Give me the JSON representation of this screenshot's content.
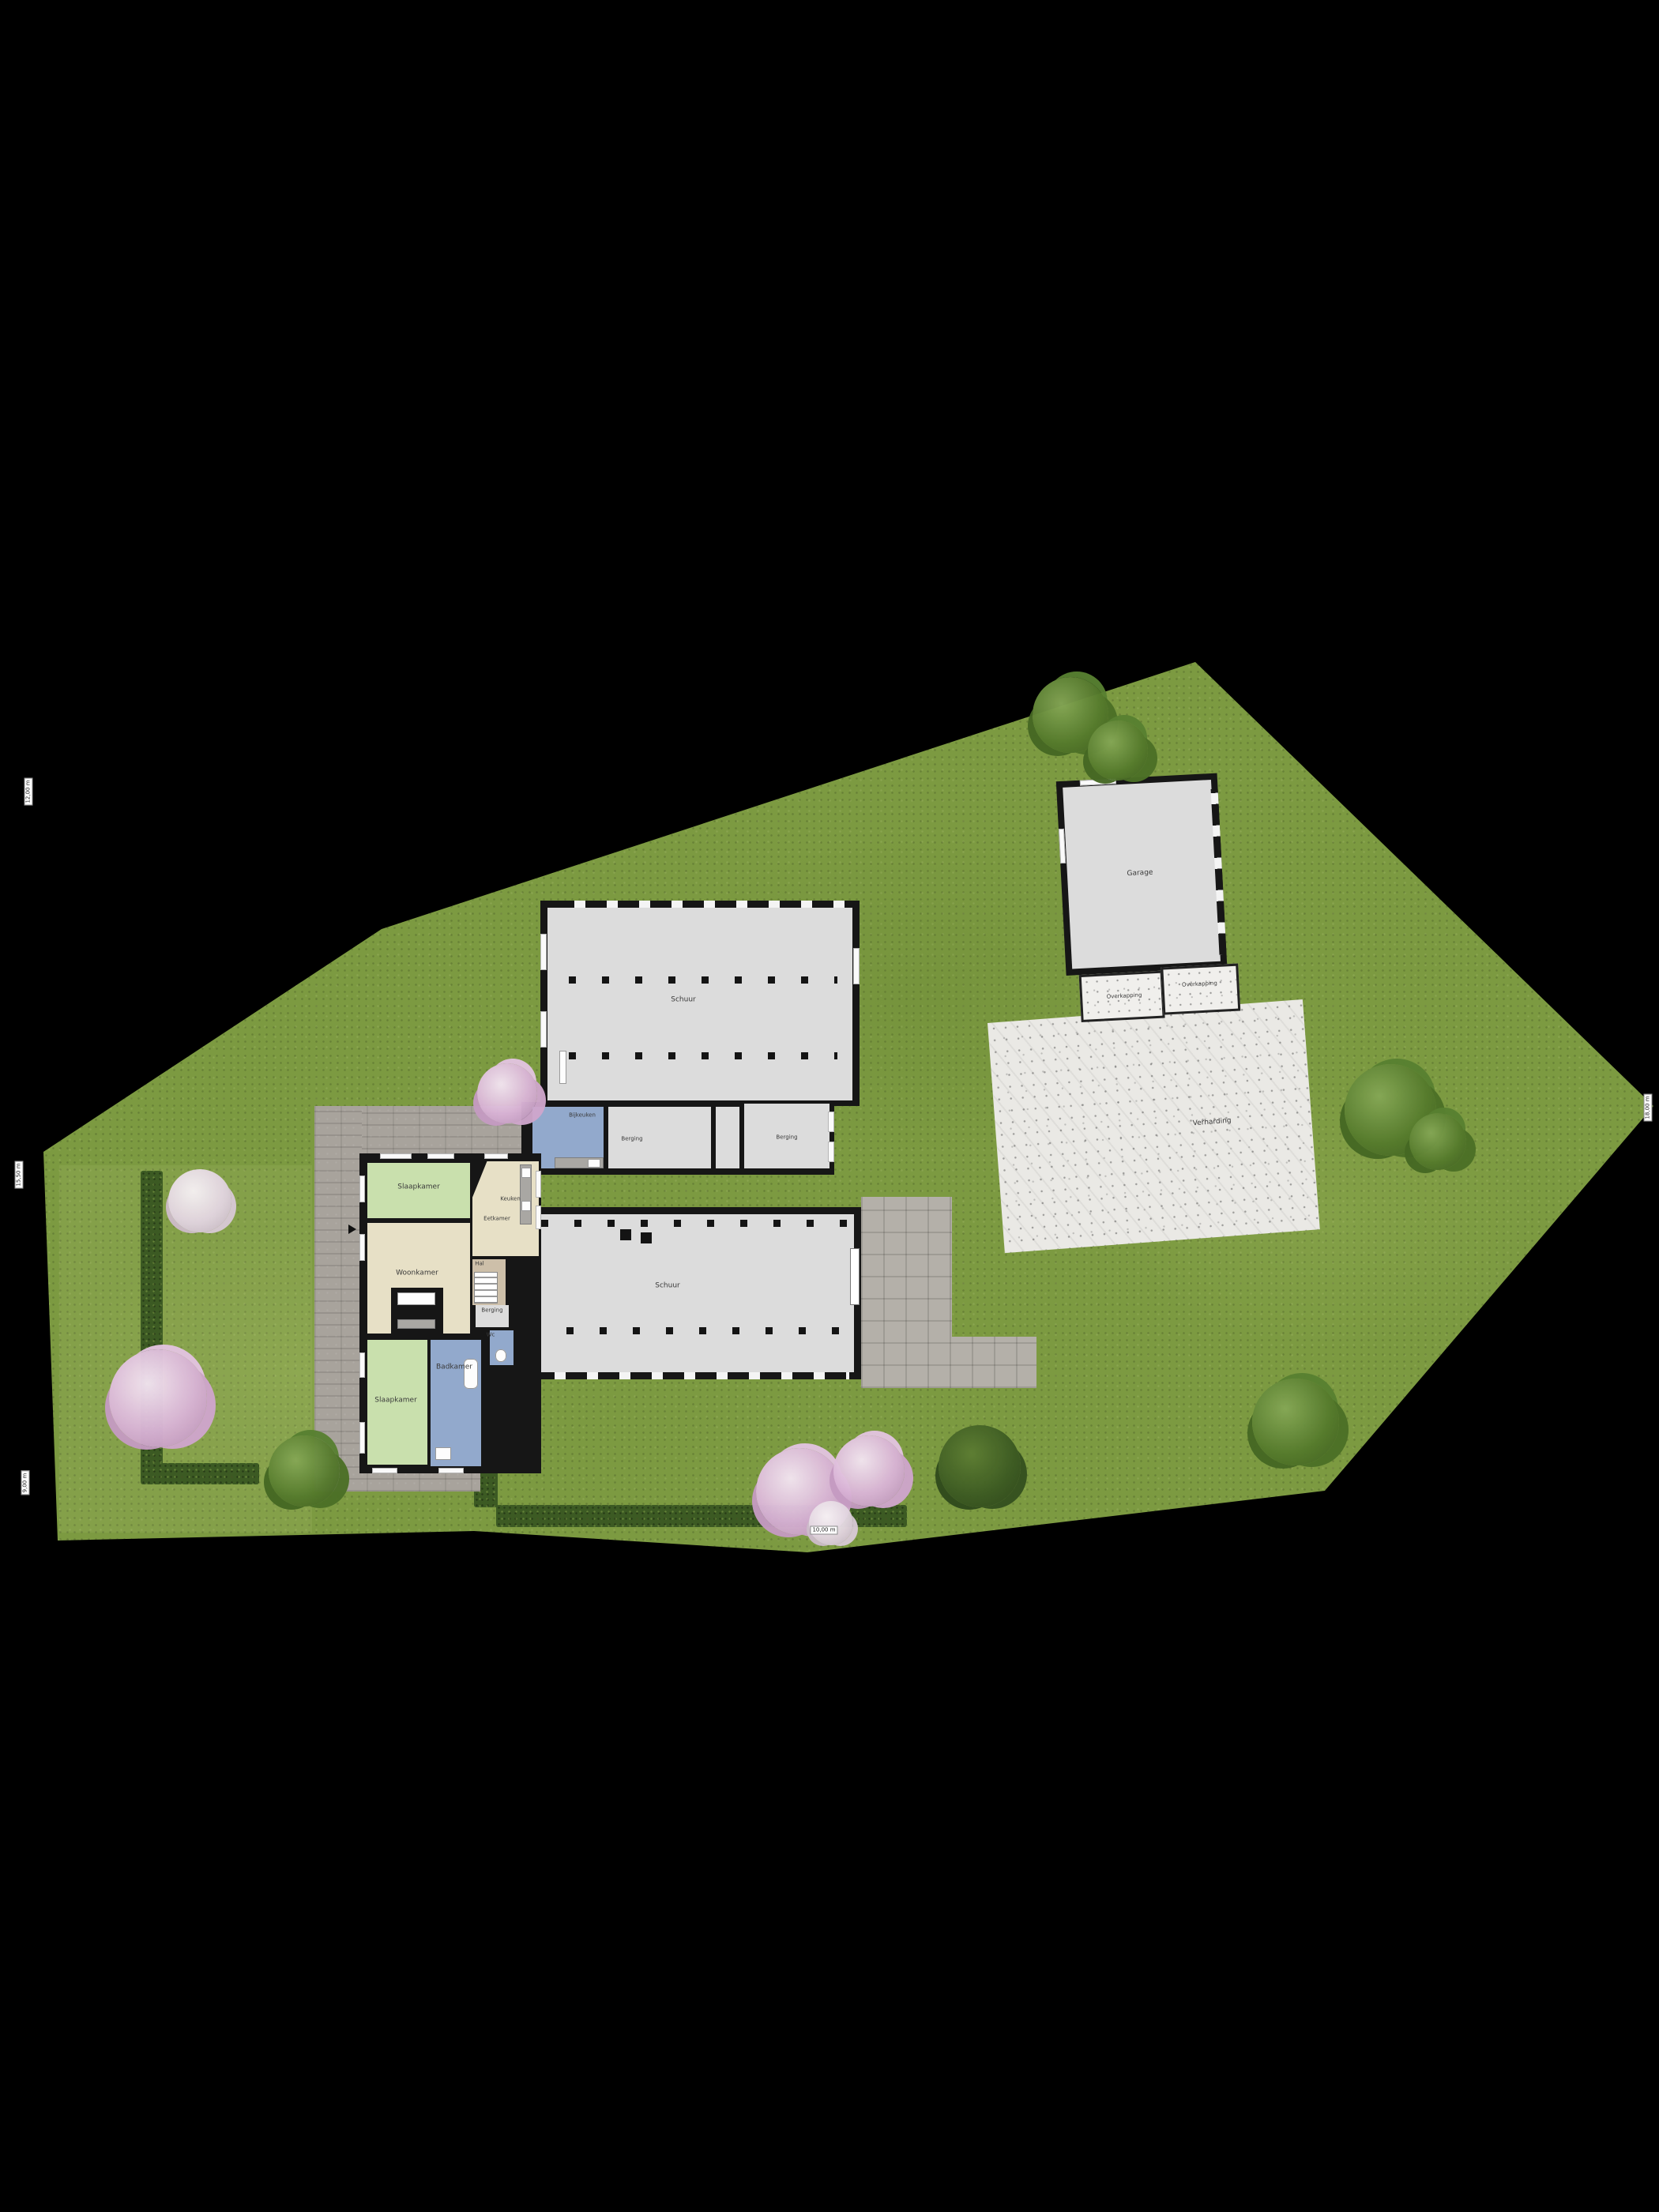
{
  "plan": {
    "type": "site-plan-floorplan",
    "background": "#000000"
  },
  "rooms": {
    "slaapkamer_1": "Slaapkamer",
    "woonkamer": "Woonkamer",
    "keuken": "Keuken",
    "eetkamer": "Eetkamer",
    "hal": "Hal",
    "berging_huis": "Berging",
    "wc": "Wc",
    "slaapkamer_2": "Slaapkamer",
    "badkamer": "Badkamer",
    "bijkeuken": "Bijkeuken",
    "berging_tussen_1": "Berging",
    "berging_tussen_2": "Berging",
    "schuur_boven": "Schuur",
    "schuur_beneden": "Schuur",
    "garage": "Garage",
    "overkapping_links": "Overkapping",
    "overkapping_rechts": "Overkapping",
    "verharding": "Verharding"
  },
  "dimensions": {
    "left_top": "12,00 m",
    "left_middle": "15,50 m",
    "left_bottom": "9,00 m",
    "right": "18,00 m",
    "bottom": "10,00 m"
  },
  "colors": {
    "grass": "#7c9a41",
    "hedge": "#3c5a23",
    "wall": "#161616",
    "floor_gray": "#dcdcdc",
    "bedroom_green": "#c9e0ad",
    "living_cream": "#e7e0c6",
    "bath_blue": "#92a9cc",
    "hall_tan": "#cdbfa9",
    "paving": "#a8a39c",
    "terrace": "#b4b0a9",
    "concrete": "#eae9e5",
    "blossom": "#d9b3d6"
  }
}
